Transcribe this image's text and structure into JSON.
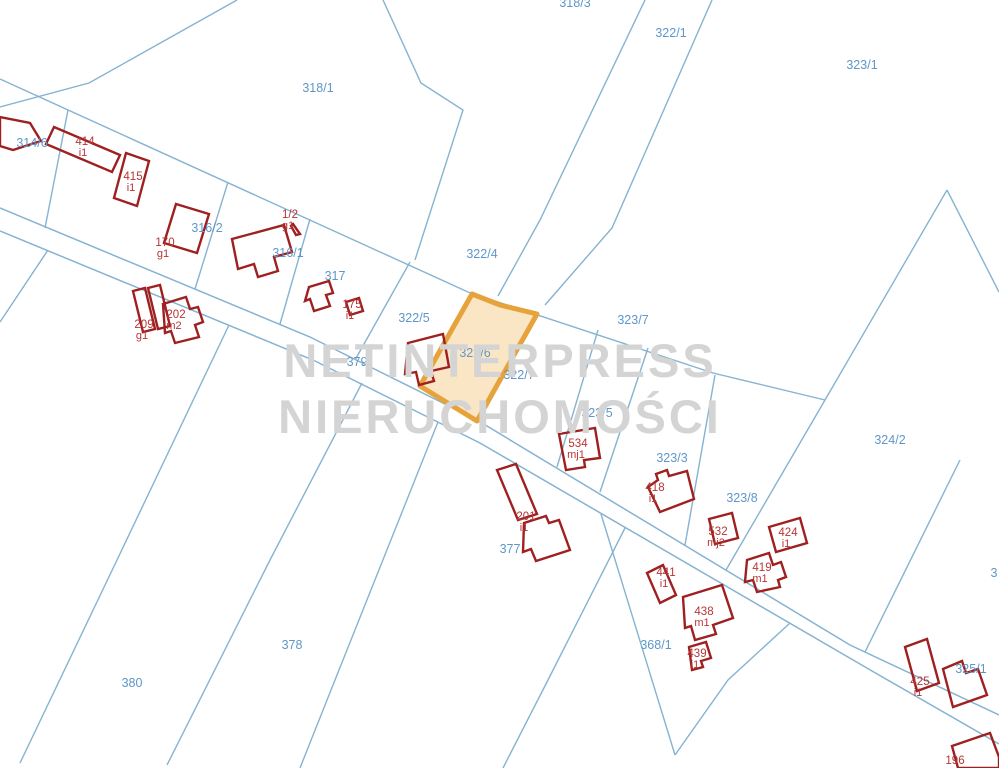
{
  "map": {
    "title": "cadastral-parcel-map",
    "background": "#ffffff",
    "colors": {
      "boundary": "#85b3d1",
      "road": "#85b3d1",
      "parcel_label": "#5e97c9",
      "building_outline": "#9e2020",
      "building_label": "#b63535",
      "highlight_stroke": "#e7a33b",
      "highlight_fill": "#fae6c5",
      "watermark": "#d4d4d4"
    },
    "watermark": {
      "line1": "NETINTERPRESS",
      "line2": "NIERUCHOMOŚCI"
    },
    "highlight": {
      "label": "322/6",
      "label_x": 475,
      "label_y": 353,
      "points": "472,294 500,305 537,314 477,421 420,386"
    },
    "parcel_labels": [
      {
        "text": "318/3",
        "x": 575,
        "y": 3
      },
      {
        "text": "322/1",
        "x": 671,
        "y": 33
      },
      {
        "text": "323/1",
        "x": 862,
        "y": 65
      },
      {
        "text": "318/1",
        "x": 318,
        "y": 88
      },
      {
        "text": "314/6",
        "x": 32,
        "y": 143
      },
      {
        "text": "316/2",
        "x": 207,
        "y": 228
      },
      {
        "text": "316/1",
        "x": 288,
        "y": 253
      },
      {
        "text": "322/4",
        "x": 482,
        "y": 254
      },
      {
        "text": "317",
        "x": 335,
        "y": 276
      },
      {
        "text": "322/5",
        "x": 414,
        "y": 318
      },
      {
        "text": "323/7",
        "x": 633,
        "y": 320
      },
      {
        "text": "379",
        "x": 357,
        "y": 362
      },
      {
        "text": "322/7",
        "x": 519,
        "y": 375
      },
      {
        "text": "323/5",
        "x": 597,
        "y": 413
      },
      {
        "text": "324/2",
        "x": 890,
        "y": 440
      },
      {
        "text": "323/3",
        "x": 672,
        "y": 458
      },
      {
        "text": "323/8",
        "x": 742,
        "y": 498
      },
      {
        "text": "377",
        "x": 510,
        "y": 549
      },
      {
        "text": "3",
        "x": 994,
        "y": 573
      },
      {
        "text": "368/1",
        "x": 656,
        "y": 645
      },
      {
        "text": "378",
        "x": 292,
        "y": 645
      },
      {
        "text": "325/1",
        "x": 971,
        "y": 669
      },
      {
        "text": "380",
        "x": 132,
        "y": 683
      }
    ],
    "buildings": [
      {
        "number": "",
        "suffix": "",
        "lx": -50,
        "ly": -50,
        "points": "0,117 30,123 41,141 13,150 0,146"
      },
      {
        "number": "414",
        "suffix": "i1",
        "lx": 85,
        "ly": 141,
        "points": "54,127 120,155 112,172 46,144"
      },
      {
        "number": "415",
        "suffix": "i1",
        "lx": 133,
        "ly": 176,
        "points": "126,153 149,161 137,206 114,198"
      },
      {
        "number": "170",
        "suffix": "g1",
        "lx": 165,
        "ly": 242,
        "points": "176,204 209,214 197,253 164,243"
      },
      {
        "number": "1/2",
        "suffix": "g1",
        "lx": 290,
        "ly": 214,
        "points": "293,224 300,234 296,235 291,226"
      },
      {
        "number": "",
        "suffix": "",
        "lx": -50,
        "ly": -50,
        "points": "232,239 284,225 292,252 274,257 278,271 258,277 254,264 238,269"
      },
      {
        "number": "",
        "suffix": "",
        "lx": -50,
        "ly": -50,
        "points": "309,287 329,281 333,293 326,295 330,306 314,311 310,299 305,301"
      },
      {
        "number": "175",
        "suffix": "i1",
        "lx": 352,
        "ly": 304,
        "points": "346,302 359,298 363,311 350,315"
      },
      {
        "number": "209",
        "suffix": "g1",
        "lx": 144,
        "ly": 324,
        "points": "133,291 145,288 155,329 143,332"
      },
      {
        "number": "",
        "suffix": "",
        "lx": -50,
        "ly": -50,
        "points": "148,288 160,285 170,326 158,329"
      },
      {
        "number": "202",
        "suffix": "m2",
        "lx": 176,
        "ly": 314,
        "points": "163,304 186,297 190,309 198,307 203,322 195,325 199,337 175,343 171,331 165,333"
      },
      {
        "number": "",
        "suffix": "",
        "lx": -50,
        "ly": -50,
        "points": "408,343 443,334 449,367 431,371 434,381 419,385 416,372 405,374"
      },
      {
        "number": "534",
        "suffix": "mj1",
        "lx": 578,
        "ly": 443,
        "points": "559,434 595,428 600,458 584,460 585,467 566,470"
      },
      {
        "number": "201",
        "suffix": "i1",
        "lx": 526,
        "ly": 516,
        "points": "497,470 516,464 537,514 518,520"
      },
      {
        "number": "",
        "suffix": "",
        "lx": -50,
        "ly": -50,
        "points": "524,523 546,516 549,523 559,520 570,550 536,561 531,549 523,552"
      },
      {
        "number": "418",
        "suffix": "i1",
        "lx": 655,
        "ly": 487,
        "points": "648,487 658,480 656,474 667,470 669,476 687,471 694,499 660,512"
      },
      {
        "number": "532",
        "suffix": "mj2",
        "lx": 718,
        "ly": 531,
        "points": "709,519 732,513 738,538 715,544"
      },
      {
        "number": "424",
        "suffix": "i1",
        "lx": 788,
        "ly": 532,
        "points": "769,527 800,518 807,543 776,552"
      },
      {
        "number": "419",
        "suffix": "m1",
        "lx": 762,
        "ly": 567,
        "points": "747,560 769,553 773,565 781,562 786,577 778,580 780,587 757,592 753,580 745,582"
      },
      {
        "number": "441",
        "suffix": "i1",
        "lx": 666,
        "ly": 572,
        "points": "647,573 663,565 676,595 660,603"
      },
      {
        "number": "438",
        "suffix": "m1",
        "lx": 704,
        "ly": 611,
        "points": "683,597 722,585 733,618 713,625 716,634 695,640 691,626 685,628"
      },
      {
        "number": "439",
        "suffix": "i1",
        "lx": 697,
        "ly": 653,
        "points": "689,647 706,642 711,658 701,661 703,667 692,670"
      },
      {
        "number": "425",
        "suffix": "i1",
        "lx": 920,
        "ly": 681,
        "points": "905,647 927,639 939,683 917,691"
      },
      {
        "number": "",
        "suffix": "",
        "lx": -50,
        "ly": -50,
        "points": "943,669 962,661 966,673 978,669 987,695 953,707"
      },
      {
        "number": "196",
        "suffix": "",
        "lx": 955,
        "ly": 760,
        "points": "952,746 990,733 999,757 999,768 958,768"
      }
    ],
    "boundaries": [
      {
        "points": "0,79 468,292"
      },
      {
        "points": "237,0 89,83 0,107"
      },
      {
        "points": "383,0 421,83 463,110 415,260"
      },
      {
        "points": "645,0 540,220 498,296"
      },
      {
        "points": "712,0 612,228 545,305"
      },
      {
        "points": "468,292 713,373 825,400"
      },
      {
        "points": "947,190 825,400 726,570"
      },
      {
        "points": "947,190 999,292"
      },
      {
        "points": "598,330 557,467"
      },
      {
        "points": "648,348 600,492"
      },
      {
        "points": "715,375 685,545"
      },
      {
        "points": "960,460 865,652"
      },
      {
        "points": "410,262 355,360"
      },
      {
        "points": "310,219 280,324"
      },
      {
        "points": "228,182 195,289"
      },
      {
        "points": "68,110 45,228"
      },
      {
        "points": "48,250 0,322"
      },
      {
        "points": "229,325 117,560 20,763"
      },
      {
        "points": "362,383 270,560 167,765"
      },
      {
        "points": "438,422 335,680 300,768"
      },
      {
        "points": "625,528 548,680 503,768"
      },
      {
        "points": "601,514 675,755"
      },
      {
        "points": "675,755 728,680 790,623"
      }
    ],
    "road": [
      {
        "points": "0,208 310,337 477,420 850,645 999,715"
      },
      {
        "points": "0,231 313,360 480,443 872,671 999,744"
      }
    ]
  }
}
